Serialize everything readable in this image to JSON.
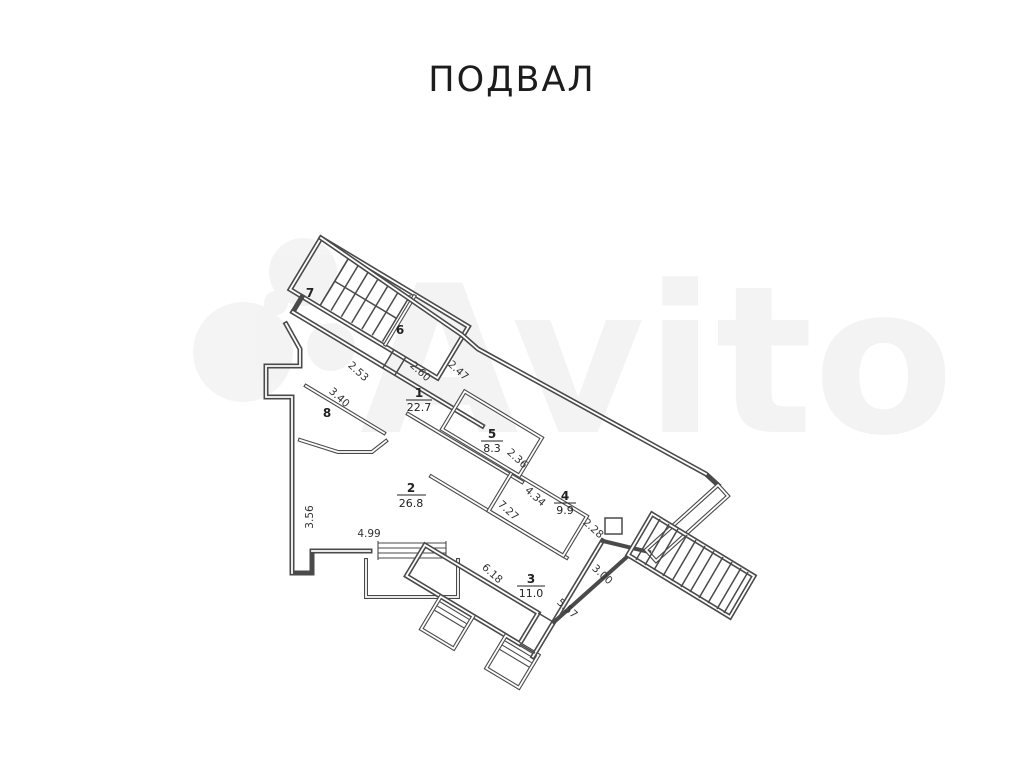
{
  "page": {
    "title": "ПОДВАЛ",
    "watermark": "Avito"
  },
  "plan": {
    "rooms": [
      {
        "number": "7",
        "area": ""
      },
      {
        "number": "6",
        "area": ""
      },
      {
        "number": "1",
        "area": "22.7"
      },
      {
        "number": "5",
        "area": "8.3"
      },
      {
        "number": "8",
        "area": ""
      },
      {
        "number": "2",
        "area": "26.8"
      },
      {
        "number": "4",
        "area": "9.9"
      },
      {
        "number": "3",
        "area": "11.0"
      }
    ],
    "dimensions": [
      {
        "value": "2.53"
      },
      {
        "value": "2.60"
      },
      {
        "value": "2.47"
      },
      {
        "value": "3.40"
      },
      {
        "value": "3.56"
      },
      {
        "value": "4.99"
      },
      {
        "value": "2.36"
      },
      {
        "value": "4.34"
      },
      {
        "value": "7.27"
      },
      {
        "value": "2.28"
      },
      {
        "value": "3.00"
      },
      {
        "value": "6.18"
      },
      {
        "value": "5.57"
      }
    ],
    "colors": {
      "wall": "#4a4a4a",
      "text": "#2a2a2a",
      "background": "#ffffff"
    }
  }
}
